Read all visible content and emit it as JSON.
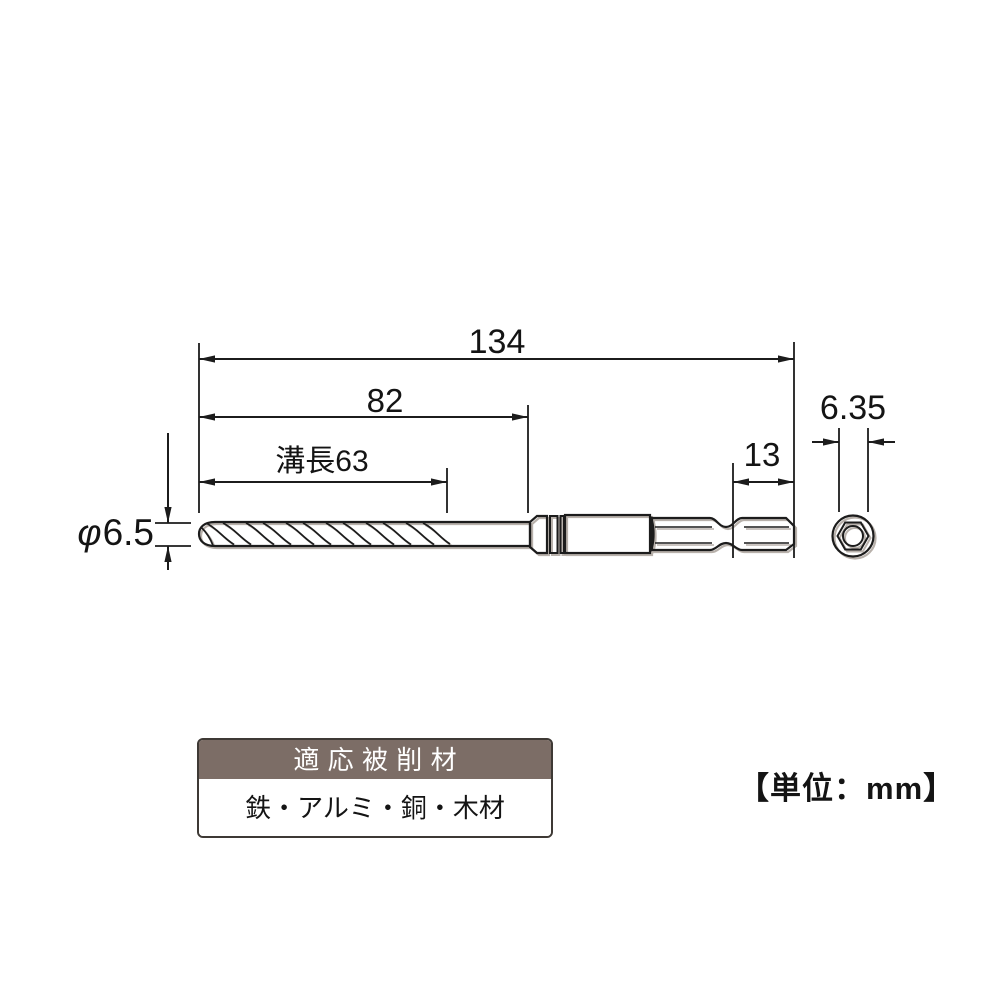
{
  "drawing": {
    "title_hint": "drill bit dimensional diagram",
    "unit_note": "【単位：mm】",
    "dimensions": {
      "overall_length": {
        "label": "134",
        "mm": 134
      },
      "body_length": {
        "label": "82",
        "mm": 82
      },
      "flute_length": {
        "label": "溝長63",
        "mm": 63
      },
      "hex_tail_length": {
        "label": "13",
        "mm": 13
      },
      "hex_shank_width": {
        "label": "6.35",
        "mm": 6.35
      },
      "drill_diameter": {
        "phi": "φ",
        "value": "6.5",
        "mm": 6.5
      }
    }
  },
  "spec_table": {
    "header": "適応被削材",
    "materials": "鉄・アルミ・銅・木材"
  },
  "colors": {
    "line": "#1c1c1c",
    "table_header_bg": "#7c6d66",
    "table_border": "#3e3935",
    "shadow": "#b8b1ab",
    "background": "#ffffff"
  }
}
